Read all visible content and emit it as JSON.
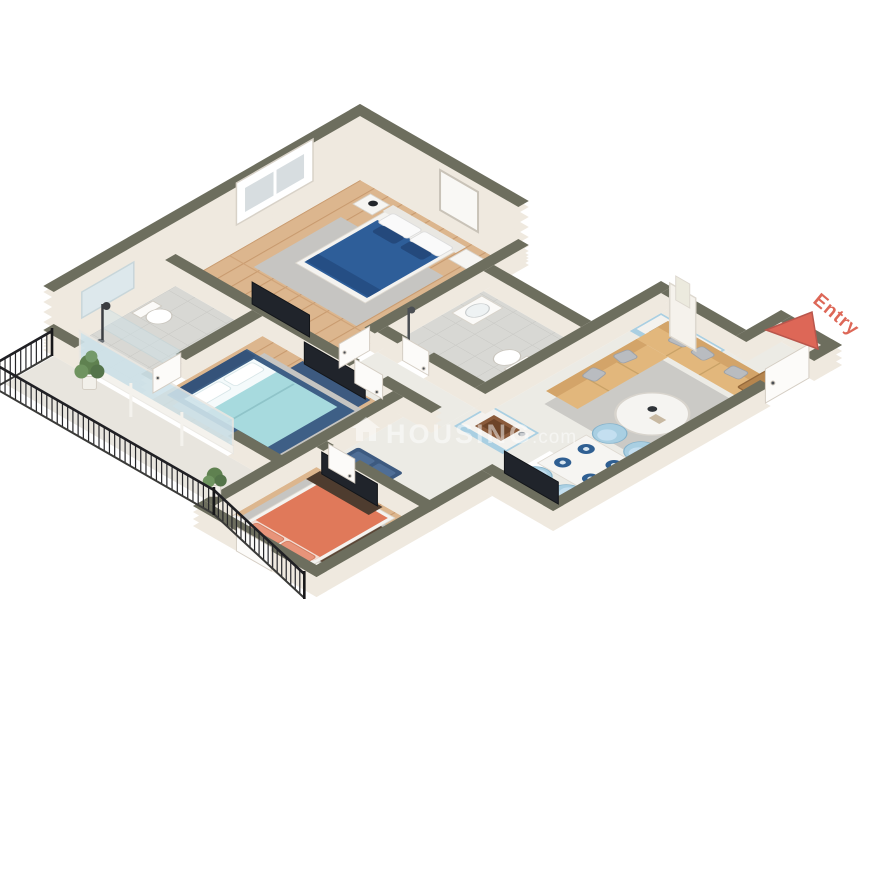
{
  "scene": {
    "title": "3D Floor Plan",
    "projection": "isometric",
    "background": "#ffffff"
  },
  "entry": {
    "label": "Entry",
    "color": "#dd6757"
  },
  "watermark": {
    "icon": "house-icon",
    "brand": "HOUSING",
    "suffix": ".com",
    "color": "#ffffff",
    "opacity": 0.5
  },
  "palette": {
    "wall_top": "#6d6e5e",
    "wall_face": "#efe9df",
    "wood": "#dcb68e",
    "plank_line": "#c89a6e",
    "marble": "#ecebe5",
    "tile": "#d8d8d4",
    "tile_line": "#c6c6c2",
    "rug_gray": "#c6c5c2",
    "navy": "#3d5a80",
    "blue_bed": "#2e5e99",
    "aqua_bed": "#a7dade",
    "coral_bed": "#e0795a",
    "sofa_tan": "#e2b77c",
    "chair_blue": "#a9cfe2",
    "counter_blue": "#a9cfe2",
    "furniture_brown": "#5b4737",
    "doormat": "#b5854e",
    "railing": "#26262a",
    "glass": "#cfe3ea"
  },
  "rooms": [
    {
      "name": "bedroom-1",
      "furniture": [
        "double-bed-blue",
        "nightstand-left",
        "nightstand-right",
        "tv-unit",
        "rug",
        "window",
        "picture-frame"
      ]
    },
    {
      "name": "common-bathroom",
      "furniture": [
        "toilet",
        "shower-set",
        "glass-partition",
        "frosted-window"
      ]
    },
    {
      "name": "attached-bathroom",
      "furniture": [
        "wall-hung-toilet",
        "washbasin",
        "shower-set"
      ]
    },
    {
      "name": "master-bedroom",
      "furniture": [
        "double-bed-aqua",
        "tv-shelf",
        "rug",
        "sliding-balcony-door"
      ]
    },
    {
      "name": "bedroom-3",
      "furniture": [
        "double-bed-coral",
        "wardrobe",
        "tv-unit",
        "nightstand-left",
        "nightstand-right",
        "rug"
      ]
    },
    {
      "name": "kitchen",
      "furniture": [
        "cooktop-counter",
        "chimney-hood",
        "sink-island"
      ]
    },
    {
      "name": "living-room",
      "furniture": [
        "l-shaped-sofa",
        "throw-pillows",
        "coffee-table",
        "tv-stand",
        "rug",
        "doormat",
        "entry-door",
        "basket"
      ]
    },
    {
      "name": "dining-area",
      "furniture": [
        "dining-table",
        "chair-1",
        "chair-2",
        "chair-3",
        "chair-4",
        "plates"
      ]
    },
    {
      "name": "balcony",
      "furniture": [
        "iron-railing",
        "potted-plant-1",
        "potted-plant-2"
      ]
    },
    {
      "name": "hallway",
      "furniture": [
        "bench"
      ]
    }
  ]
}
